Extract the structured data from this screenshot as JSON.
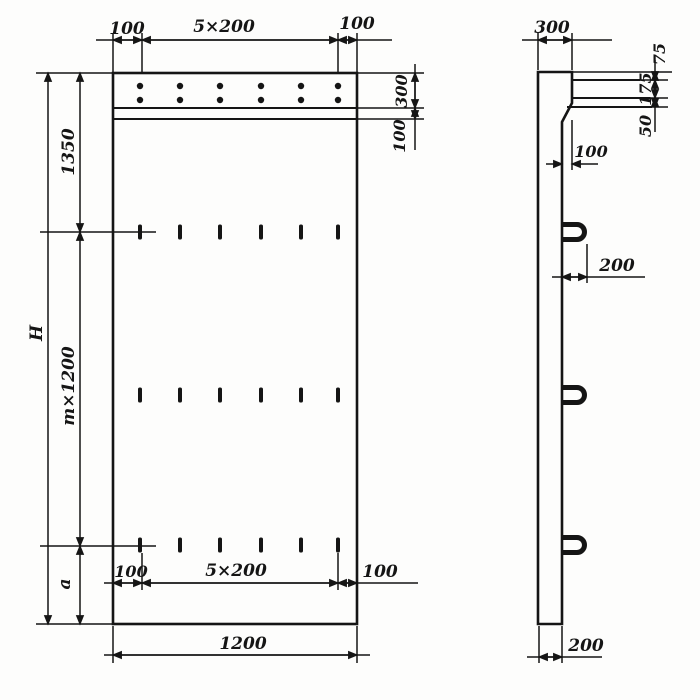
{
  "colors": {
    "ink": "#151515",
    "paper": "#fdfdfc"
  },
  "front": {
    "dim_top_left": "100",
    "dim_top_span": "5×200",
    "dim_top_right": "100",
    "dim_band_height": "300",
    "dim_band_gap": "100",
    "dim_left_top_offset": "1350",
    "dim_total_height": "H",
    "dim_module_height": "m×1200",
    "dim_bottom_offset": "a",
    "dim_bottom_left": "100",
    "dim_bottom_span": "5×200",
    "dim_bottom_right": "100",
    "dim_overall_width": "1200"
  },
  "side": {
    "dim_top_width": "300",
    "dim_ledge_top": "75",
    "dim_ledge_mid": "175",
    "dim_ledge_bottom": "50",
    "dim_step": "100",
    "dim_loop_offset": "200",
    "dim_thickness": "200"
  }
}
